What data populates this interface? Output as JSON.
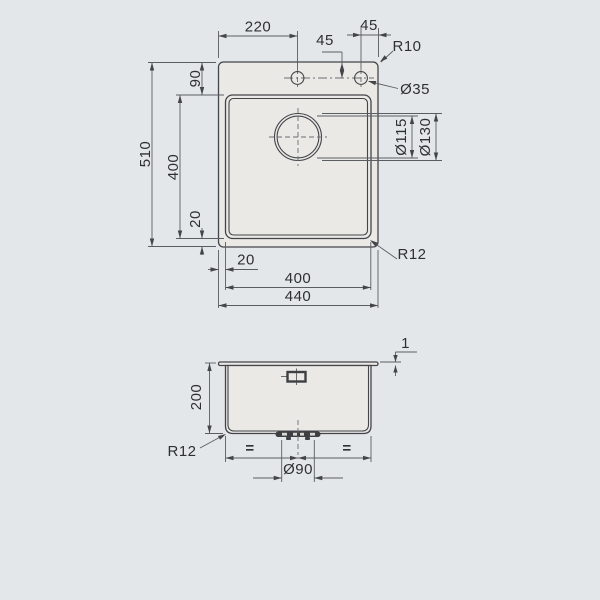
{
  "colors": {
    "background": "#e4e7ea",
    "surface": "#eae9e6",
    "line": "#43454a",
    "text": "#2e3033"
  },
  "top_view": {
    "labels": {
      "left_edge_to_faucet": "220",
      "faucet_offset_from_top": "45",
      "faucet_to_right_edge": "45",
      "outer_corner_radius": "R10",
      "faucet_hole_diameter": "Ø35",
      "top_edge_to_bowl": "90",
      "overall_depth": "510",
      "bowl_depth": "400",
      "bowl_to_bottom_edge": "20",
      "left_edge_to_bowl": "20",
      "bowl_width": "400",
      "overall_width": "440",
      "drain_inner_diameter": "Ø115",
      "drain_outer_diameter": "Ø130",
      "bowl_corner_radius": "R12"
    }
  },
  "front_view": {
    "labels": {
      "rim_thickness": "1",
      "bowl_height": "200",
      "bottom_corner_radius": "R12",
      "equal_spacing_left": "=",
      "equal_spacing_right": "=",
      "drain_diameter": "Ø90"
    }
  }
}
